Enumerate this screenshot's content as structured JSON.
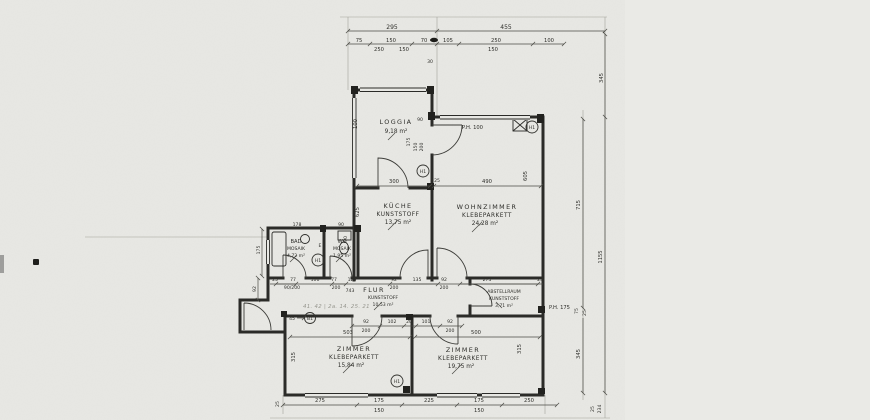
{
  "rooms": {
    "loggia": {
      "name": "LOGGIA",
      "area": "9,18 m²"
    },
    "kueche": {
      "name": "KÜCHE",
      "floor": "KUNSTSTOFF",
      "area": "13,75 m²"
    },
    "wohnzimmer": {
      "name": "WOHNZIMMER",
      "floor": "KLEBEPARKETT",
      "area": "24,28 m²"
    },
    "bad": {
      "name": "BAD",
      "floor": "MOSAIK",
      "area": "4,72 m²"
    },
    "wc": {
      "name": "WC",
      "floor": "MOSAIK",
      "area": "1,95 m²"
    },
    "flur": {
      "name": "FLUR",
      "floor": "KUNSTSTOFF",
      "area": "10,53 m²"
    },
    "abstellraum": {
      "name": "ABSTELLRAUM",
      "floor": "KUNSTSTOFF",
      "area": "3,71 m²"
    },
    "zimmer1": {
      "name": "ZIMMER",
      "floor": "KLEBEPARKETT",
      "area": "15,84 m²"
    },
    "zimmer2": {
      "name": "ZIMMER",
      "floor": "KLEBEPARKETT",
      "area": "19,75 m²"
    }
  },
  "labels": {
    "ph100": "P.H. 100",
    "ph175": "P.H. 175",
    "h1": "H1",
    "b1": "B1",
    "e": "E",
    "pencil_note": "41. 42 | 2a. 14. 25. 21"
  },
  "dims": {
    "top_total": [
      "295",
      "455"
    ],
    "top_detail": [
      "75",
      "150",
      "70",
      "105",
      "250",
      "100"
    ],
    "top_sub": [
      "250",
      "150",
      "150"
    ],
    "upper_mid": [
      "300",
      "490",
      "25"
    ],
    "loggia": [
      "100",
      "30",
      "90",
      "175",
      "150",
      "200"
    ],
    "kueche": [
      "625",
      "90"
    ],
    "wohnzimmer": [
      "605"
    ],
    "bad_wc": [
      "178",
      "90",
      "175",
      "92"
    ],
    "corridor_upper": [
      "25",
      "77",
      "106",
      "77",
      "120",
      "92",
      "135",
      "92",
      "275",
      "25"
    ],
    "corridor_upper_sub": [
      "90/200",
      "200",
      "743",
      "200",
      "200"
    ],
    "corridor_lower": [
      "92",
      "102",
      "20",
      "101",
      "92"
    ],
    "corridor_lower_sub": [
      "200",
      "200"
    ],
    "room_widths": [
      "503",
      "500"
    ],
    "room_heights": [
      "315",
      "315"
    ],
    "entry": [
      "45"
    ],
    "bottom": [
      "25",
      "275",
      "175",
      "225",
      "175",
      "250"
    ],
    "bottom_sub": [
      "150",
      "150"
    ],
    "right": [
      "345",
      "715",
      "1155",
      "75",
      "25",
      "345"
    ],
    "right_bottom": [
      "25",
      "234"
    ]
  }
}
